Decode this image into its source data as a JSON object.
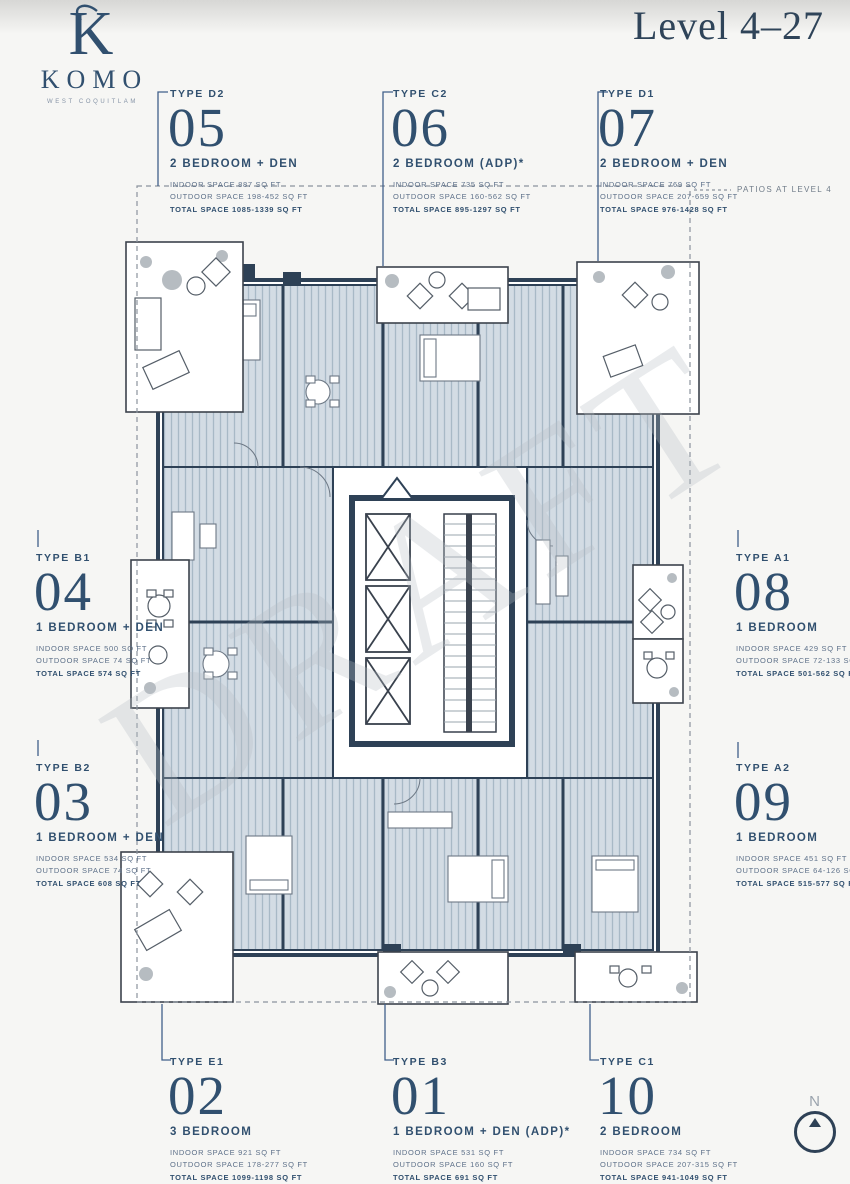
{
  "brand": {
    "monogram": "K",
    "name": "KOMO",
    "tagline": "WEST COQUITLAM"
  },
  "title": "Level 4–27",
  "annotations": {
    "patios": "PATIOS AT LEVEL 4",
    "north": "N",
    "watermark": "DRAFT"
  },
  "colors": {
    "navy": "#31506f",
    "wall": "#2e4156",
    "hatch": "#d3dce4",
    "hatch_line": "#a8b9c6"
  },
  "units": [
    {
      "type": "TYPE D2",
      "number": "05",
      "name": "2 BEDROOM + DEN",
      "indoor": "INDOOR SPACE 887 SQ FT",
      "outdoor": "OUTDOOR SPACE 198-452 SQ FT",
      "total": "TOTAL SPACE 1085-1339 SQ FT"
    },
    {
      "type": "TYPE C2",
      "number": "06",
      "name": "2 BEDROOM (ADP)*",
      "indoor": "INDOOR SPACE 735 SQ FT",
      "outdoor": "OUTDOOR SPACE 160-562 SQ FT",
      "total": "TOTAL SPACE 895-1297 SQ FT"
    },
    {
      "type": "TYPE D1",
      "number": "07",
      "name": "2 BEDROOM + DEN",
      "indoor": "INDOOR SPACE 769 SQ FT",
      "outdoor": "OUTDOOR SPACE 207-659 SQ FT",
      "total": "TOTAL SPACE 976-1428 SQ FT"
    },
    {
      "type": "TYPE B1",
      "number": "04",
      "name": "1 BEDROOM + DEN",
      "indoor": "INDOOR SPACE 500 SQ FT",
      "outdoor": "OUTDOOR SPACE 74 SQ FT",
      "total": "TOTAL SPACE 574 SQ FT"
    },
    {
      "type": "TYPE A1",
      "number": "08",
      "name": "1 BEDROOM",
      "indoor": "INDOOR SPACE 429 SQ FT",
      "outdoor": "OUTDOOR SPACE 72-133 SQ FT",
      "total": "TOTAL SPACE 501-562 SQ FT"
    },
    {
      "type": "TYPE B2",
      "number": "03",
      "name": "1 BEDROOM + DEN",
      "indoor": "INDOOR SPACE 534 SQ FT",
      "outdoor": "OUTDOOR SPACE 74 SQ FT",
      "total": "TOTAL SPACE 608 SQ FT"
    },
    {
      "type": "TYPE A2",
      "number": "09",
      "name": "1 BEDROOM",
      "indoor": "INDOOR SPACE 451 SQ FT",
      "outdoor": "OUTDOOR SPACE 64-126 SQ FT",
      "total": "TOTAL SPACE 515-577 SQ FT"
    },
    {
      "type": "TYPE E1",
      "number": "02",
      "name": "3 BEDROOM",
      "indoor": "INDOOR SPACE 921 SQ FT",
      "outdoor": "OUTDOOR SPACE 178-277 SQ FT",
      "total": "TOTAL SPACE 1099-1198 SQ FT"
    },
    {
      "type": "TYPE B3",
      "number": "01",
      "name": "1 BEDROOM + DEN (ADP)*",
      "indoor": "INDOOR SPACE 531 SQ FT",
      "outdoor": "OUTDOOR SPACE 160 SQ FT",
      "total": "TOTAL SPACE 691 SQ FT"
    },
    {
      "type": "TYPE C1",
      "number": "10",
      "name": "2 BEDROOM",
      "indoor": "INDOOR SPACE 734 SQ FT",
      "outdoor": "OUTDOOR SPACE 207-315 SQ FT",
      "total": "TOTAL SPACE 941-1049 SQ FT"
    }
  ]
}
